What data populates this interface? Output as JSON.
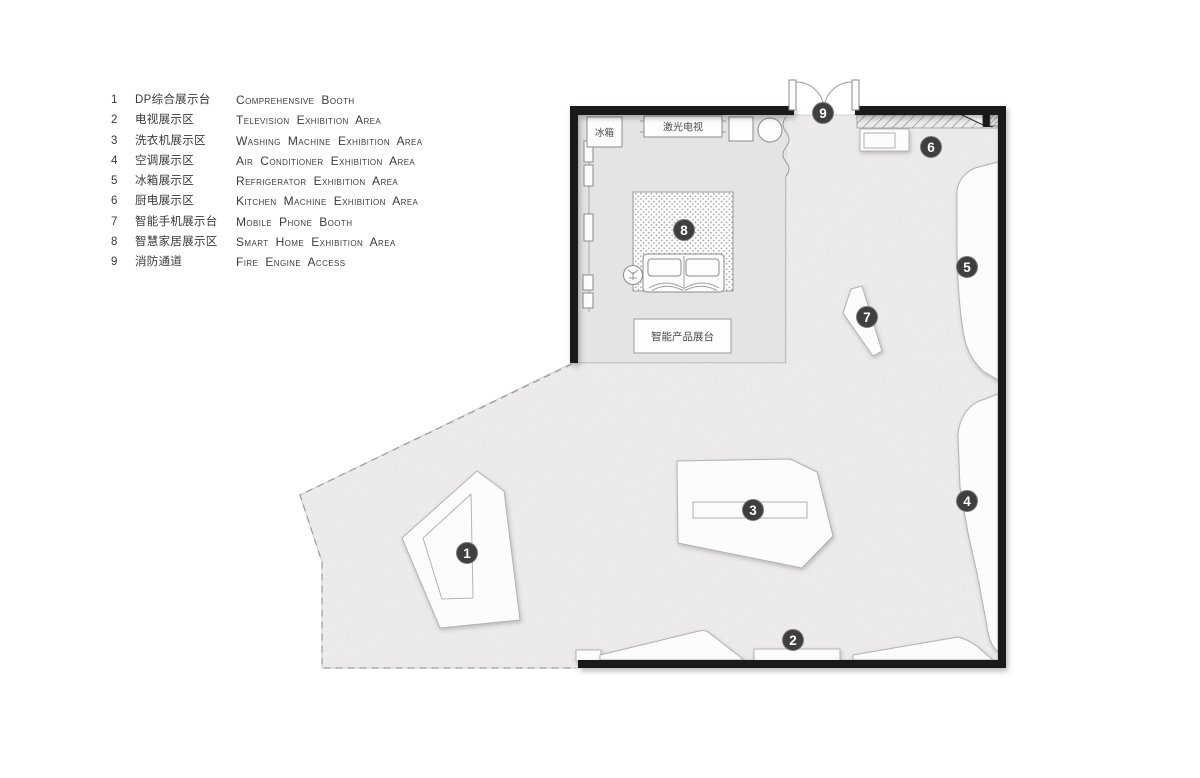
{
  "legend": {
    "items": [
      {
        "num": "1",
        "zh": "DP综合展示台",
        "en": "Comprehensive Booth"
      },
      {
        "num": "2",
        "zh": "电视展示区",
        "en": "Television Exhibition Area"
      },
      {
        "num": "3",
        "zh": "洗衣机展示区",
        "en": "Washing Machine Exhibition Area"
      },
      {
        "num": "4",
        "zh": "空调展示区",
        "en": "Air Conditioner Exhibition Area"
      },
      {
        "num": "5",
        "zh": "冰箱展示区",
        "en": "Refrigerator Exhibition Area"
      },
      {
        "num": "6",
        "zh": "厨电展示区",
        "en": "Kitchen Machine Exhibition Area"
      },
      {
        "num": "7",
        "zh": "智能手机展示台",
        "en": "Mobile Phone Booth"
      },
      {
        "num": "8",
        "zh": "智慧家居展示区",
        "en": "Smart Home Exhibition Area"
      },
      {
        "num": "9",
        "zh": "消防通道",
        "en": "Fire Engine Access"
      }
    ]
  },
  "plan": {
    "room_labels": {
      "fridge": "冰箱",
      "laser_tv": "激光电视",
      "smart_product_booth": "智能产品展台"
    },
    "markers": [
      {
        "number": "1"
      },
      {
        "number": "2"
      },
      {
        "number": "3"
      },
      {
        "number": "4"
      },
      {
        "number": "5"
      },
      {
        "number": "6"
      },
      {
        "number": "7"
      },
      {
        "number": "8"
      },
      {
        "number": "9"
      }
    ],
    "colors": {
      "wall": "#1a1a1a",
      "floor": "#efeeec",
      "room_fill": "#e4e4e3",
      "booth_fill": "#fcfcfb",
      "marker_fill": "#3f3f3f",
      "marker_text": "#ffffff"
    }
  }
}
